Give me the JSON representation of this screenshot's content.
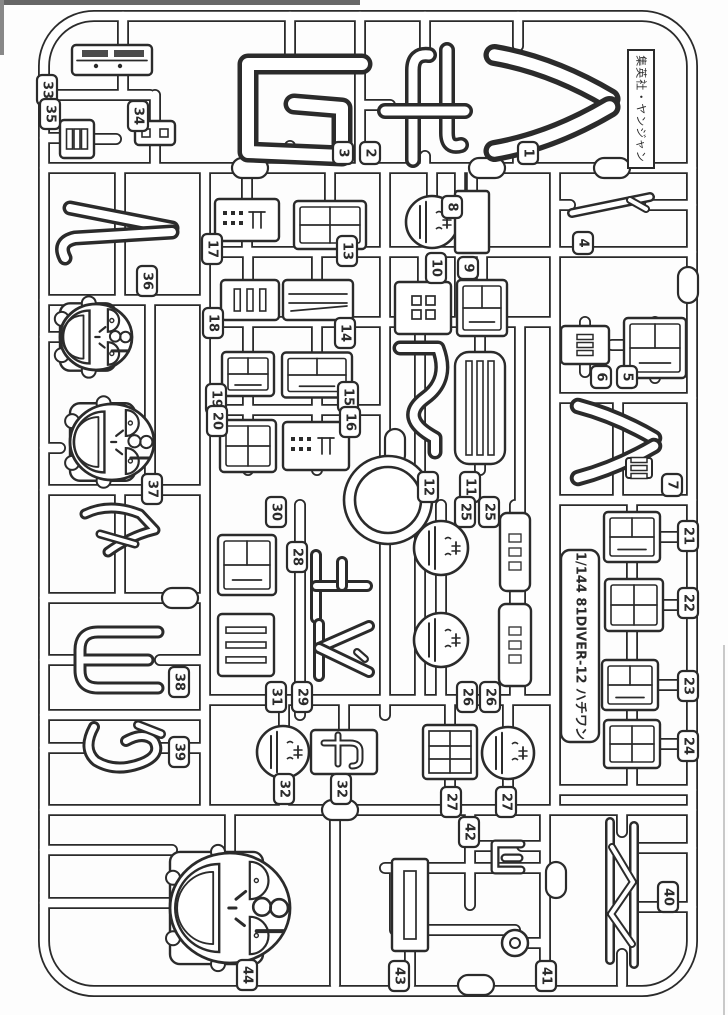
{
  "meta": {
    "ink": "#2b2b2b",
    "paper": "#fdfdfd",
    "white": "#ffffff",
    "edge_artifact_color": "#666666",
    "description_labels": {
      "sheet": "model-kit-runner-sprue",
      "scale_note": "1/144"
    }
  },
  "captions": {
    "publisher": "集英社・ヤンジャン",
    "kit": "1/144 81DIVER-12 ハチワン"
  },
  "frame": {
    "x": 44,
    "y": 16,
    "w": 648,
    "h": 975,
    "rx": 50
  },
  "runners": [
    [
      44,
      95,
      150,
      95
    ],
    [
      123,
      16,
      123,
      95
    ],
    [
      155,
      95,
      155,
      123
    ],
    [
      155,
      145,
      155,
      168
    ],
    [
      44,
      138,
      62,
      138
    ],
    [
      94,
      139,
      116,
      139
    ],
    [
      360,
      16,
      360,
      168
    ],
    [
      290,
      16,
      290,
      62
    ],
    [
      290,
      146,
      290,
      168
    ],
    [
      425,
      16,
      425,
      52
    ],
    [
      425,
      156,
      425,
      168
    ],
    [
      518,
      16,
      518,
      46
    ],
    [
      518,
      144,
      518,
      168
    ],
    [
      360,
      105,
      390,
      105
    ],
    [
      44,
      168,
      692,
      168
    ],
    [
      205,
      168,
      205,
      810
    ],
    [
      385,
      168,
      385,
      456
    ],
    [
      385,
      544,
      385,
      715
    ],
    [
      555,
      168,
      555,
      810
    ],
    [
      460,
      168,
      460,
      322
    ],
    [
      432,
      168,
      432,
      252
    ],
    [
      472,
      168,
      472,
      252
    ],
    [
      247,
      168,
      247,
      252
    ],
    [
      330,
      168,
      330,
      252
    ],
    [
      570,
      205,
      555,
      205
    ],
    [
      650,
      205,
      692,
      205
    ],
    [
      205,
      252,
      692,
      252
    ],
    [
      205,
      322,
      555,
      322
    ],
    [
      555,
      398,
      692,
      398
    ],
    [
      555,
      500,
      692,
      500
    ],
    [
      205,
      410,
      385,
      410
    ],
    [
      44,
      300,
      205,
      300
    ],
    [
      44,
      490,
      205,
      490
    ],
    [
      44,
      598,
      205,
      598
    ],
    [
      44,
      715,
      205,
      715
    ],
    [
      150,
      300,
      150,
      490
    ],
    [
      120,
      168,
      120,
      300
    ],
    [
      120,
      490,
      120,
      598
    ],
    [
      44,
      337,
      60,
      337
    ],
    [
      44,
      448,
      60,
      448
    ],
    [
      44,
      660,
      80,
      660
    ],
    [
      160,
      660,
      205,
      660
    ],
    [
      44,
      748,
      88,
      748
    ],
    [
      160,
      748,
      205,
      748
    ],
    [
      248,
      252,
      248,
      470
    ],
    [
      317,
      252,
      317,
      470
    ],
    [
      423,
      252,
      423,
      322
    ],
    [
      482,
      252,
      482,
      322
    ],
    [
      420,
      322,
      420,
      700
    ],
    [
      480,
      322,
      480,
      470
    ],
    [
      520,
      322,
      520,
      700
    ],
    [
      300,
      505,
      300,
      715
    ],
    [
      441,
      505,
      441,
      700
    ],
    [
      515,
      505,
      515,
      700
    ],
    [
      205,
      700,
      555,
      700
    ],
    [
      555,
      790,
      692,
      790
    ],
    [
      632,
      500,
      632,
      790
    ],
    [
      585,
      322,
      585,
      372
    ],
    [
      655,
      322,
      655,
      378
    ],
    [
      612,
      345,
      632,
      345
    ],
    [
      618,
      398,
      618,
      500
    ],
    [
      284,
      700,
      284,
      810
    ],
    [
      344,
      700,
      344,
      810
    ],
    [
      450,
      700,
      450,
      810
    ],
    [
      508,
      700,
      508,
      810
    ],
    [
      650,
      537,
      692,
      537
    ],
    [
      652,
      605,
      692,
      605
    ],
    [
      650,
      685,
      692,
      685
    ],
    [
      652,
      744,
      692,
      744
    ],
    [
      44,
      810,
      692,
      810
    ],
    [
      335,
      810,
      335,
      985
    ],
    [
      470,
      810,
      470,
      905
    ],
    [
      545,
      810,
      545,
      985
    ],
    [
      385,
      868,
      545,
      868
    ],
    [
      395,
      868,
      395,
      930
    ],
    [
      395,
      930,
      515,
      930
    ],
    [
      527,
      943,
      545,
      943
    ],
    [
      410,
      948,
      410,
      985
    ],
    [
      44,
      850,
      172,
      850
    ],
    [
      44,
      903,
      172,
      903
    ],
    [
      230,
      810,
      230,
      852
    ],
    [
      247,
      960,
      247,
      985
    ],
    [
      637,
      848,
      692,
      848
    ],
    [
      637,
      907,
      692,
      907
    ],
    [
      622,
      810,
      622,
      832
    ],
    [
      622,
      954,
      622,
      985
    ],
    [
      470,
      846,
      492,
      846
    ],
    [
      522,
      846,
      545,
      846
    ]
  ],
  "pads": [
    [
      250,
      168,
      0
    ],
    [
      487,
      168,
      0
    ],
    [
      612,
      168,
      0
    ],
    [
      395,
      447,
      1
    ],
    [
      180,
      598,
      0
    ],
    [
      556,
      880,
      1
    ],
    [
      476,
      985,
      0
    ],
    [
      688,
      285,
      1
    ],
    [
      340,
      810,
      0
    ]
  ],
  "parts": [
    {
      "k": "box",
      "x": 112,
      "y": 60,
      "w": 80,
      "h": 30,
      "p": "hatch",
      "n": "33"
    },
    {
      "k": "box",
      "x": 155,
      "y": 133,
      "w": 40,
      "h": 24,
      "p": "holes2",
      "n": "34"
    },
    {
      "k": "box",
      "x": 77,
      "y": 139,
      "w": 34,
      "h": 38,
      "p": "slatsv",
      "n": "35"
    },
    {
      "k": "wa",
      "x": 300,
      "y": 112,
      "n": "3"
    },
    {
      "k": "chi",
      "x": 425,
      "y": 105,
      "n": "2"
    },
    {
      "k": "chev",
      "x": 552,
      "y": 103,
      "w": 115,
      "h": 96,
      "n": "1"
    },
    {
      "k": "thin",
      "x": 612,
      "y": 205,
      "n": "4"
    },
    {
      "k": "box",
      "x": 247,
      "y": 220,
      "w": 64,
      "h": 42,
      "p": "dots",
      "n": "17"
    },
    {
      "k": "box",
      "x": 330,
      "y": 225,
      "w": 72,
      "h": 48,
      "p": "cross",
      "n": "13"
    },
    {
      "k": "head",
      "x": 432,
      "y": 222,
      "r": 26,
      "n": "8"
    },
    {
      "k": "plate",
      "x": 472,
      "y": 222,
      "w": 34,
      "h": 62,
      "n": "9"
    },
    {
      "k": "box",
      "x": 250,
      "y": 300,
      "w": 58,
      "h": 40,
      "p": "slatsv",
      "n": "18"
    },
    {
      "k": "box",
      "x": 318,
      "y": 300,
      "w": 70,
      "h": 40,
      "p": "layers",
      "n": "14"
    },
    {
      "k": "box",
      "x": 423,
      "y": 308,
      "w": 56,
      "h": 52,
      "p": "holes4",
      "n": "10"
    },
    {
      "k": "box",
      "x": 482,
      "y": 308,
      "w": 50,
      "h": 56,
      "p": "maze",
      "n": "9b"
    },
    {
      "k": "box",
      "x": 585,
      "y": 345,
      "w": 48,
      "h": 38,
      "p": "bars",
      "n": "6"
    },
    {
      "k": "box",
      "x": 655,
      "y": 348,
      "w": 62,
      "h": 60,
      "p": "maze",
      "n": "5"
    },
    {
      "k": "box",
      "x": 248,
      "y": 374,
      "w": 52,
      "h": 44,
      "p": "maze",
      "n": "19"
    },
    {
      "k": "box",
      "x": 317,
      "y": 375,
      "w": 70,
      "h": 45,
      "p": "maze",
      "n": "15"
    },
    {
      "k": "box",
      "x": 248,
      "y": 446,
      "w": 56,
      "h": 52,
      "p": "cross",
      "n": "20"
    },
    {
      "k": "box",
      "x": 316,
      "y": 446,
      "w": 66,
      "h": 48,
      "p": "dots",
      "n": "16"
    },
    {
      "k": "scurve",
      "x": 420,
      "y": 400,
      "n": "12"
    },
    {
      "k": "box",
      "x": 480,
      "y": 408,
      "w": 50,
      "h": 112,
      "p": "slatsv",
      "rx": 14,
      "n": "11"
    },
    {
      "k": "chev",
      "x": 616,
      "y": 442,
      "w": 76,
      "h": 72,
      "box": 1,
      "n": "7"
    },
    {
      "k": "ring",
      "x": 388,
      "y": 500,
      "ro": 44,
      "ri": 33,
      "n": "ring"
    },
    {
      "k": "n2",
      "x": 120,
      "y": 230,
      "n": "36"
    },
    {
      "k": "face",
      "x": 96,
      "y": 337,
      "rx": 36,
      "ry": 33,
      "n": "37a"
    },
    {
      "k": "face",
      "x": 112,
      "y": 442,
      "rx": 42,
      "ry": 38,
      "n": "37b"
    },
    {
      "k": "curve",
      "x": 120,
      "y": 532,
      "n": "37c"
    },
    {
      "k": "ue",
      "x": 340,
      "y": 586,
      "n": "28"
    },
    {
      "k": "dai",
      "x": 341,
      "y": 650,
      "n": "29"
    },
    {
      "k": "box",
      "x": 247,
      "y": 565,
      "w": 58,
      "h": 60,
      "p": "maze",
      "n": "30"
    },
    {
      "k": "box",
      "x": 246,
      "y": 645,
      "w": 56,
      "h": 62,
      "p": "slatsh",
      "n": "31"
    },
    {
      "k": "head",
      "x": 441,
      "y": 548,
      "r": 27,
      "n": "25a"
    },
    {
      "k": "plate2",
      "x": 515,
      "y": 552,
      "w": 30,
      "h": 78,
      "n": "25b"
    },
    {
      "k": "head",
      "x": 441,
      "y": 640,
      "r": 27,
      "n": "26a"
    },
    {
      "k": "plate2",
      "x": 515,
      "y": 645,
      "w": 32,
      "h": 82,
      "n": "26b"
    },
    {
      "k": "box",
      "x": 632,
      "y": 537,
      "w": 56,
      "h": 50,
      "p": "maze",
      "n": "21"
    },
    {
      "k": "box",
      "x": 634,
      "y": 605,
      "w": 58,
      "h": 52,
      "p": "cross",
      "n": "22"
    },
    {
      "k": "box",
      "x": 630,
      "y": 685,
      "w": 56,
      "h": 50,
      "p": "maze",
      "n": "23"
    },
    {
      "k": "box",
      "x": 632,
      "y": 744,
      "w": 56,
      "h": 48,
      "p": "cross",
      "n": "24"
    },
    {
      "k": "yo",
      "x": 118,
      "y": 660,
      "n": "38"
    },
    {
      "k": "chi2",
      "x": 124,
      "y": 747,
      "n": "39"
    },
    {
      "k": "head",
      "x": 283,
      "y": 752,
      "r": 26,
      "n": "32a"
    },
    {
      "k": "box",
      "x": 344,
      "y": 752,
      "w": 66,
      "h": 44,
      "p": "hook",
      "n": "32b"
    },
    {
      "k": "box",
      "x": 450,
      "y": 752,
      "w": 54,
      "h": 54,
      "p": "grid",
      "n": "27a"
    },
    {
      "k": "head",
      "x": 508,
      "y": 753,
      "r": 26,
      "n": "27b"
    },
    {
      "k": "bigface",
      "x": 230,
      "y": 908,
      "rx": 60,
      "ry": 55,
      "n": "44"
    },
    {
      "k": "plate",
      "x": 410,
      "y": 905,
      "w": 36,
      "h": 92,
      "slot": 1,
      "n": "43"
    },
    {
      "k": "gpiece",
      "x": 507,
      "y": 857,
      "n": "42"
    },
    {
      "k": "smallring",
      "x": 515,
      "y": 943,
      "n": "41"
    },
    {
      "k": "zig",
      "x": 622,
      "y": 892,
      "n": "40"
    }
  ],
  "tags": [
    [
      "1",
      528,
      153
    ],
    [
      "2",
      370,
      153
    ],
    [
      "3",
      343,
      153
    ],
    [
      "4",
      583,
      243
    ],
    [
      "5",
      627,
      377
    ],
    [
      "6",
      601,
      377
    ],
    [
      "7",
      672,
      485
    ],
    [
      "8",
      452,
      207
    ],
    [
      "9",
      468,
      268
    ],
    [
      "10",
      436,
      268
    ],
    [
      "11",
      470,
      487
    ],
    [
      "12",
      428,
      487
    ],
    [
      "13",
      347,
      251
    ],
    [
      "14",
      345,
      333
    ],
    [
      "15",
      348,
      397
    ],
    [
      "16",
      350,
      422
    ],
    [
      "17",
      212,
      249
    ],
    [
      "18",
      213,
      323
    ],
    [
      "19",
      216,
      399
    ],
    [
      "20",
      217,
      421
    ],
    [
      "21",
      688,
      536
    ],
    [
      "22",
      688,
      603
    ],
    [
      "23",
      688,
      686
    ],
    [
      "24",
      688,
      746
    ],
    [
      "25",
      465,
      512
    ],
    [
      "25",
      489,
      512
    ],
    [
      "26",
      467,
      697
    ],
    [
      "26",
      490,
      697
    ],
    [
      "27",
      451,
      802
    ],
    [
      "27",
      506,
      802
    ],
    [
      "28",
      297,
      557
    ],
    [
      "29",
      302,
      697
    ],
    [
      "30",
      276,
      512
    ],
    [
      "31",
      276,
      697
    ],
    [
      "32",
      284,
      789
    ],
    [
      "32",
      341,
      789
    ],
    [
      "33",
      47,
      90
    ],
    [
      "34",
      138,
      116
    ],
    [
      "35",
      50,
      114
    ],
    [
      "36",
      147,
      281
    ],
    [
      "37",
      152,
      489
    ],
    [
      "38",
      179,
      682
    ],
    [
      "39",
      179,
      752
    ],
    [
      "40",
      668,
      897
    ],
    [
      "41",
      546,
      976
    ],
    [
      "42",
      469,
      832
    ],
    [
      "43",
      399,
      976
    ],
    [
      "44",
      247,
      975
    ]
  ],
  "caption_boxes": {
    "publisher": {
      "x": 628,
      "y": 50,
      "w": 26,
      "h": 118
    },
    "kit": {
      "x": 561,
      "y": 550,
      "w": 38,
      "h": 192
    }
  },
  "artifacts": [
    {
      "x": 0,
      "y": 0,
      "w": 360,
      "h": 5,
      "c": "#666666"
    },
    {
      "x": 0,
      "y": 0,
      "w": 4,
      "h": 55,
      "c": "#888888"
    },
    {
      "x": 723,
      "y": 645,
      "w": 2,
      "h": 370,
      "c": "#c9c9c9"
    }
  ]
}
